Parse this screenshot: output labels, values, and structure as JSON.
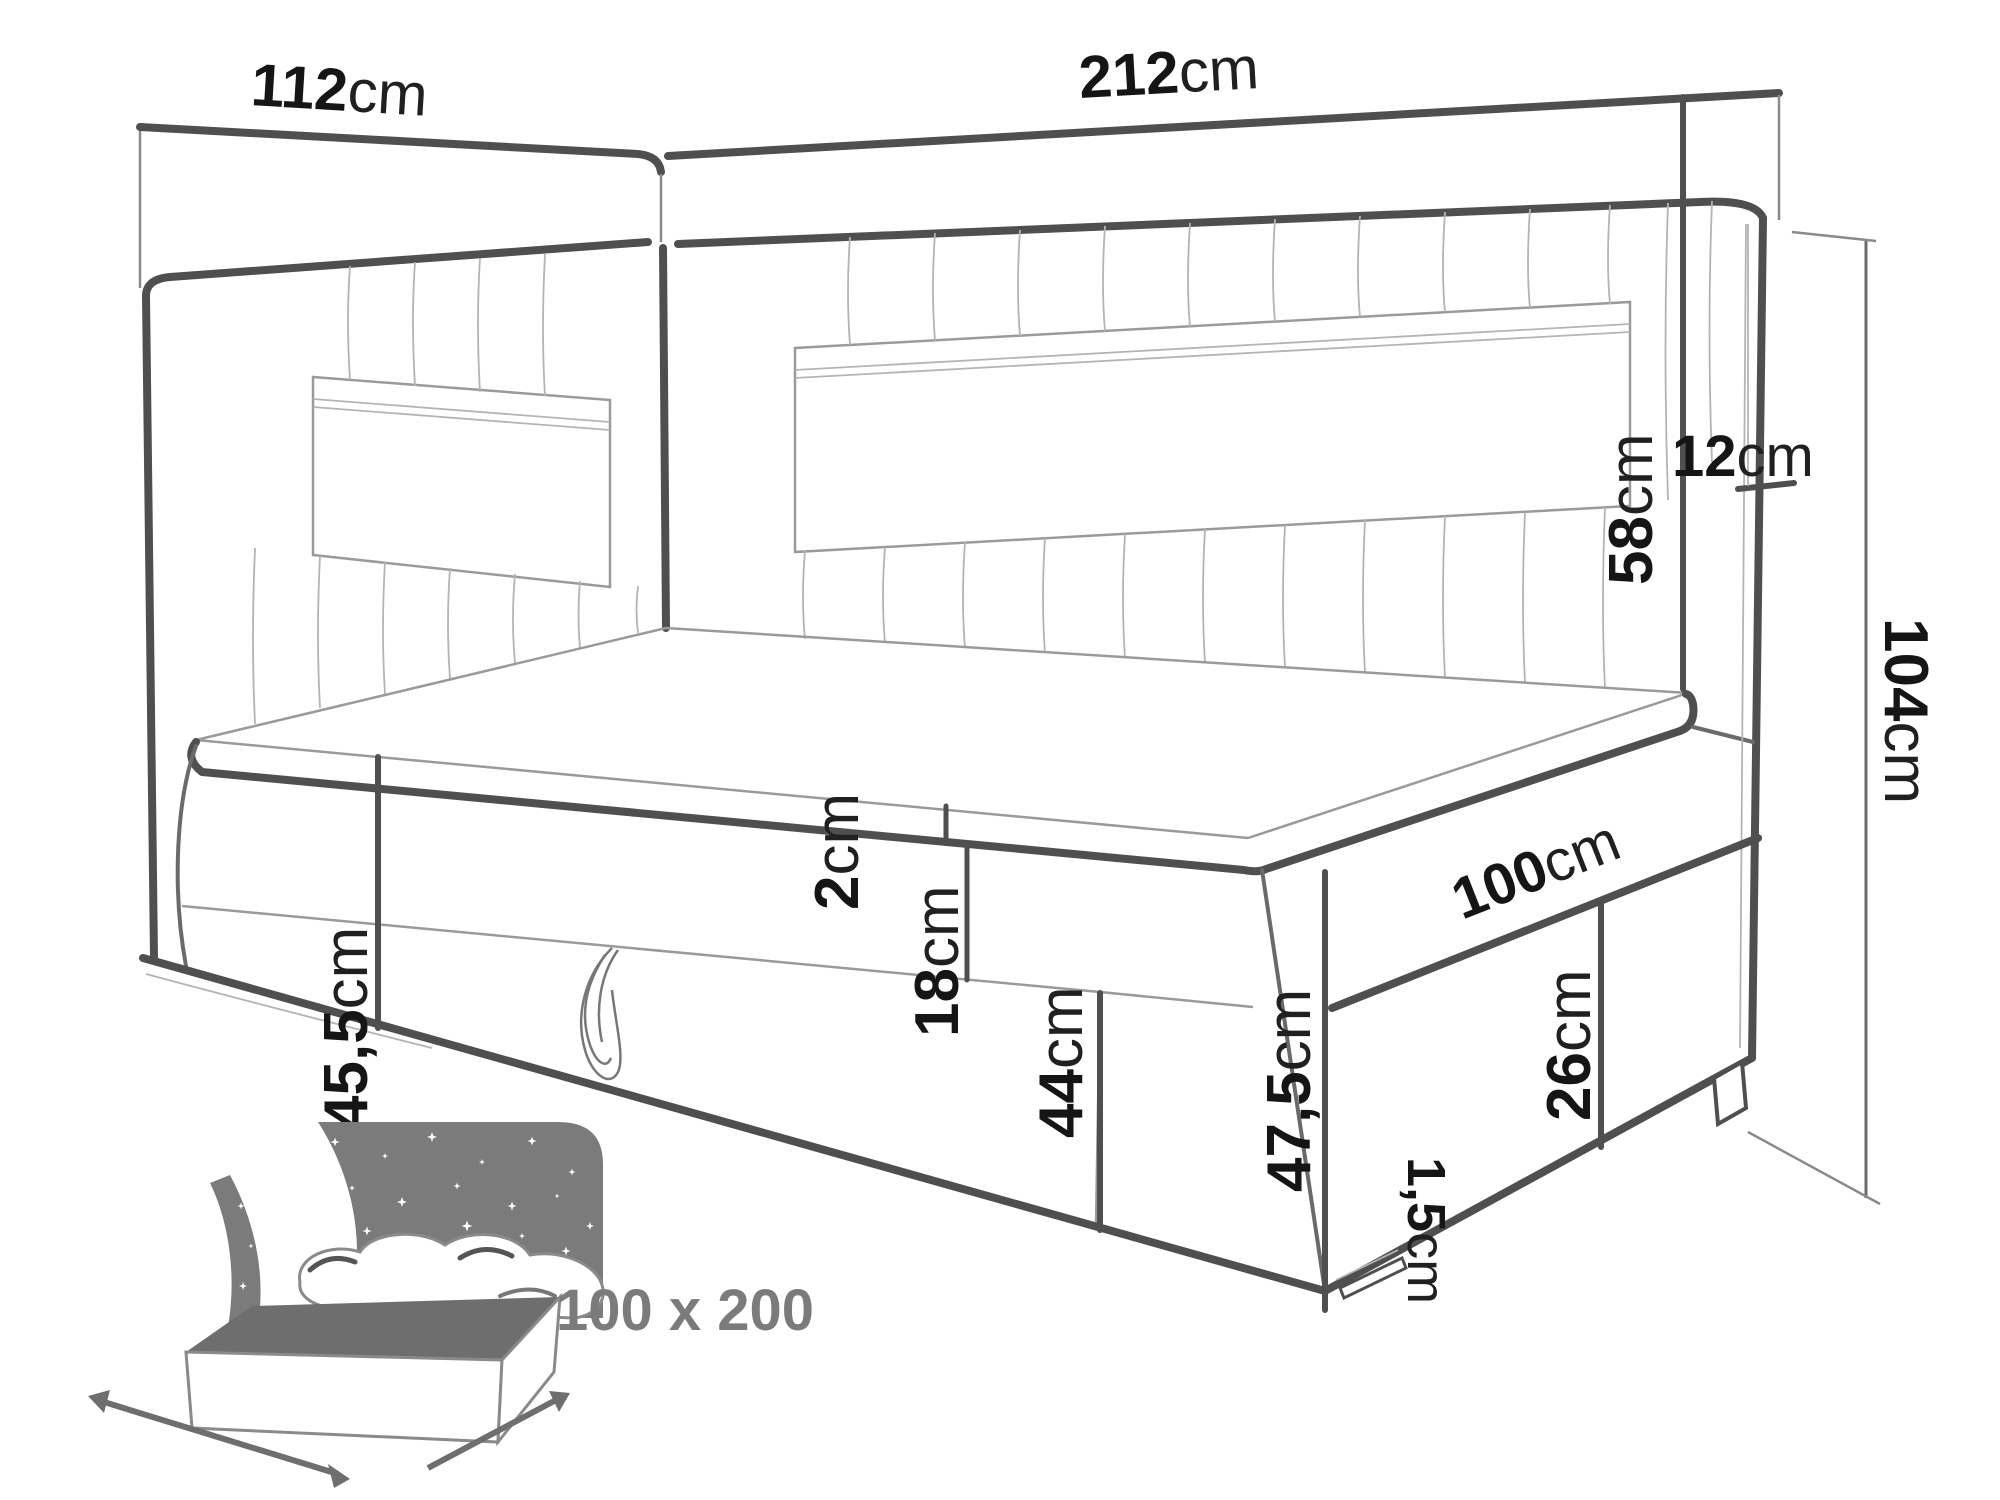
{
  "diagram_type": "corner-bed-dimension-drawing",
  "labels": {
    "w112": {
      "value": "112",
      "unit": "cm"
    },
    "w212": {
      "value": "212",
      "unit": "cm"
    },
    "t12": {
      "value": "12",
      "unit": "cm"
    },
    "h58": {
      "value": "58",
      "unit": "cm"
    },
    "h104": {
      "value": "104",
      "unit": "cm"
    },
    "h455": {
      "value": "45,5",
      "unit": "cm"
    },
    "t2": {
      "value": "2",
      "unit": "cm"
    },
    "m18": {
      "value": "18",
      "unit": "cm"
    },
    "b44": {
      "value": "44",
      "unit": "cm"
    },
    "d100": {
      "value": "100",
      "unit": "cm"
    },
    "f26": {
      "value": "26",
      "unit": "cm"
    },
    "c475": {
      "value": "47,5",
      "unit": "cm"
    },
    "p15": {
      "value": "1,5",
      "unit": "cm"
    }
  },
  "badge": {
    "size": "100 x 200"
  },
  "colors": {
    "line_dark": "#4f4f4f",
    "line_thin": "#9a9a9a",
    "text": "#151515",
    "icon_gray": "#7b7b7b",
    "mattress_gray": "#6e6e6e",
    "background": "#ffffff"
  }
}
